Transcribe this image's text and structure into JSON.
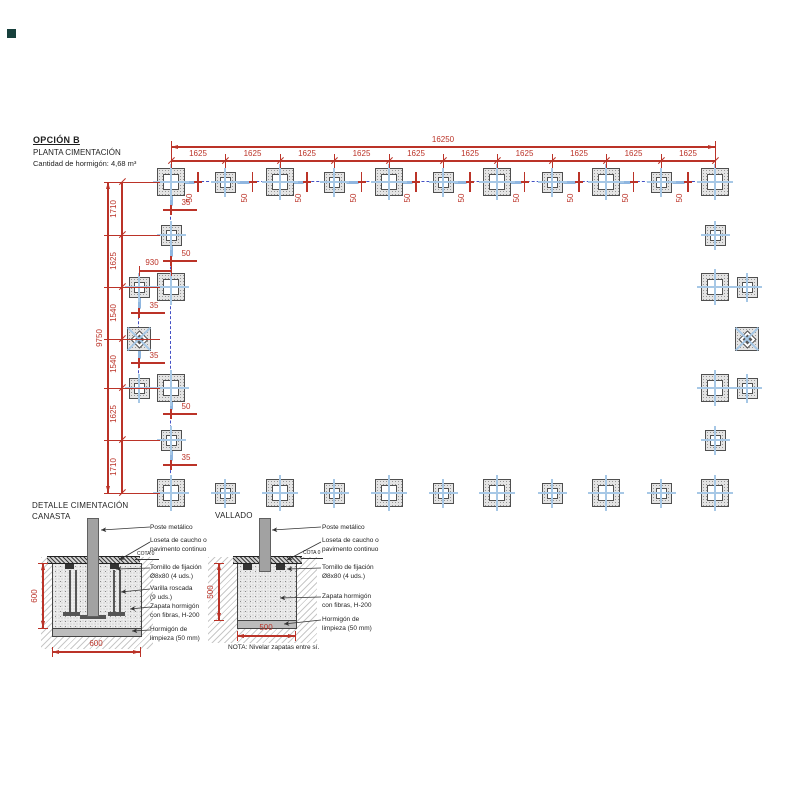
{
  "header": {
    "option": "OPCIÓN B",
    "subtitle": "PLANTA CIMENTACIÓN",
    "note": "Cantidad de hormigón: 4,68 m³"
  },
  "corner_mark": {
    "color": "#17403c"
  },
  "plan": {
    "colors": {
      "red": "#bb3328",
      "blue_dark": "#4350c5",
      "blue_mid": "#7f88cf",
      "blue_light": "#8fb6e0",
      "cross": "#a7c8e6",
      "outline": "#4f4f4f"
    },
    "footings": {
      "xs": [
        171,
        225,
        280,
        334,
        389,
        443,
        497,
        552,
        606,
        661,
        715
      ],
      "top_y": 182,
      "bottom_y": 493,
      "top_types": [
        "big",
        "small",
        "big",
        "small",
        "big",
        "small",
        "big",
        "small",
        "big",
        "small",
        "big"
      ],
      "bottom_types": [
        "big",
        "small",
        "big",
        "small",
        "big",
        "small",
        "big",
        "small",
        "big",
        "small",
        "big"
      ],
      "left": [
        {
          "x": 171,
          "y": 235,
          "type": "small"
        },
        {
          "x": 171,
          "y": 287,
          "type": "big"
        },
        {
          "x": 171,
          "y": 388,
          "type": "big"
        },
        {
          "x": 171,
          "y": 440,
          "type": "small"
        },
        {
          "x": 139,
          "y": 287,
          "type": "small"
        },
        {
          "x": 139,
          "y": 339,
          "type": "diamond"
        },
        {
          "x": 139,
          "y": 388,
          "type": "small"
        }
      ],
      "right": [
        {
          "x": 715,
          "y": 235,
          "type": "small"
        },
        {
          "x": 715,
          "y": 287,
          "type": "big"
        },
        {
          "x": 715,
          "y": 388,
          "type": "big"
        },
        {
          "x": 715,
          "y": 440,
          "type": "small"
        },
        {
          "x": 747,
          "y": 287,
          "type": "small"
        },
        {
          "x": 747,
          "y": 339,
          "type": "diamond"
        },
        {
          "x": 747,
          "y": 388,
          "type": "small"
        }
      ]
    },
    "fence": {
      "top": {
        "x1": 171,
        "x2": 715,
        "y": 182
      },
      "left": {
        "x": 171,
        "y1": 182,
        "y2": 493
      },
      "left_offset": {
        "x": 139,
        "y1": 287,
        "y2": 388
      },
      "connectors": [
        {
          "x1": 139,
          "x2": 171,
          "y": 287
        },
        {
          "x1": 139,
          "x2": 171,
          "y": 388
        }
      ]
    },
    "dimensions": {
      "top_total": {
        "label": "16250",
        "x1": 171,
        "x2": 715,
        "y": 147
      },
      "top_segments": {
        "y": 161,
        "labels": [
          "1625",
          "1625",
          "1625",
          "1625",
          "1625",
          "1625",
          "1625",
          "1625",
          "1625",
          "1625"
        ]
      },
      "top_gaps": {
        "label": "50"
      },
      "left_total": {
        "label": "9750",
        "x": 108,
        "y1": 182,
        "y2": 493
      },
      "left_segments": {
        "x": 122,
        "boundaries": [
          182,
          235,
          287,
          339,
          388,
          440,
          493
        ],
        "labels": [
          "1710",
          "1625",
          "1540",
          "1540",
          "1625",
          "1710"
        ]
      },
      "offset": {
        "label": "930",
        "x1": 139,
        "x2": 171,
        "y": 271
      },
      "left_gaps": [
        {
          "x": 171,
          "y": 210,
          "label": "35"
        },
        {
          "x": 171,
          "y": 261,
          "label": "50"
        },
        {
          "x": 139,
          "y": 313,
          "label": "35"
        },
        {
          "x": 139,
          "y": 363,
          "label": "35"
        },
        {
          "x": 171,
          "y": 414,
          "label": "50"
        },
        {
          "x": 171,
          "y": 465,
          "label": "35"
        }
      ]
    }
  },
  "details": {
    "canasta": {
      "title": [
        "DETALLE CIMENTACIÓN",
        "CANASTA"
      ],
      "cota": "COTA 0",
      "labels": [
        {
          "x": 150,
          "y": 524,
          "lines": [
            "Poste metálico"
          ]
        },
        {
          "x": 150,
          "y": 537,
          "lines": [
            "Loseta de caucho o",
            "pavimento continuo"
          ]
        },
        {
          "x": 150,
          "y": 564,
          "lines": [
            "Tornillo de fijación",
            "Ø8x80 (4 uds.)"
          ]
        },
        {
          "x": 150,
          "y": 585,
          "lines": [
            "Varilla roscada",
            "(9 uds.)"
          ]
        },
        {
          "x": 150,
          "y": 603,
          "lines": [
            "Zapata hormigón",
            "con fibras, H-200"
          ]
        },
        {
          "x": 150,
          "y": 626,
          "lines": [
            "Hormigón de",
            "limpieza (50 mm)"
          ]
        }
      ]
    },
    "vallado": {
      "title": [
        "VALLADO"
      ],
      "cota": "COTA 0",
      "note": "NOTA: Nivelar zapatas entre sí.",
      "labels": [
        {
          "x": 322,
          "y": 524,
          "lines": [
            "Poste metálico"
          ]
        },
        {
          "x": 322,
          "y": 537,
          "lines": [
            "Loseta de caucho o",
            "pavimento continuo"
          ]
        },
        {
          "x": 322,
          "y": 564,
          "lines": [
            "Tornillo de fijación",
            "Ø8x80 (4 uds.)"
          ]
        },
        {
          "x": 322,
          "y": 593,
          "lines": [
            "Zapata hormigón",
            "con fibras, H-200"
          ]
        },
        {
          "x": 322,
          "y": 616,
          "lines": [
            "Hormigón de",
            "limpieza (50 mm)"
          ]
        }
      ]
    },
    "detail_dims": [
      {
        "type": "v",
        "x": 43,
        "y1": 563,
        "y2": 628,
        "label": "600"
      },
      {
        "type": "h",
        "x1": 52,
        "x2": 140,
        "y": 652,
        "label": "600"
      },
      {
        "type": "v",
        "x": 219,
        "y1": 563,
        "y2": 620,
        "label": "500"
      },
      {
        "type": "h",
        "x1": 237,
        "x2": 295,
        "y": 636,
        "label": "500"
      }
    ]
  }
}
